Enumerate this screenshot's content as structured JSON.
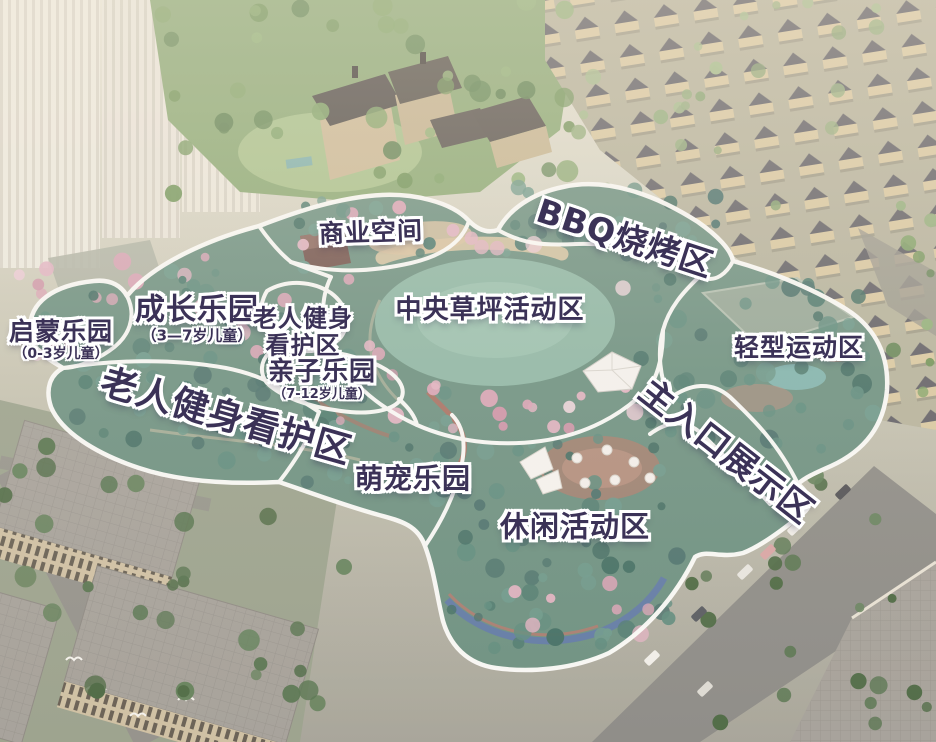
{
  "zones": {
    "qimeng": {
      "label": "启蒙乐园",
      "sub": "（0-3岁儿童）"
    },
    "chengzhang": {
      "label": "成长乐园",
      "sub": "（3—7岁儿童）"
    },
    "laoren_small": {
      "line1": "老人健身",
      "line2": "看护区"
    },
    "shangye": {
      "label": "商业空间"
    },
    "bbq": {
      "label": "BBQ烧烤区"
    },
    "zhongyang": {
      "label": "中央草坪活动区"
    },
    "qingxing": {
      "label": "轻型运动区"
    },
    "qinzi": {
      "label": "亲子乐园",
      "sub": "（7-12岁儿童）"
    },
    "laoren_large": {
      "label": "老人健身看护区"
    },
    "mengchong": {
      "label": "萌宠乐园"
    },
    "zhurukou": {
      "label": "主入口展示区"
    },
    "xiuxian": {
      "label": "休闲活动区"
    }
  },
  "colors": {
    "label_text": "#3b3257",
    "label_outline": "#ffffff",
    "zone_outline": "#ffffff",
    "lawn": "#8cb6a4",
    "park_base": "#6a8f7f"
  }
}
